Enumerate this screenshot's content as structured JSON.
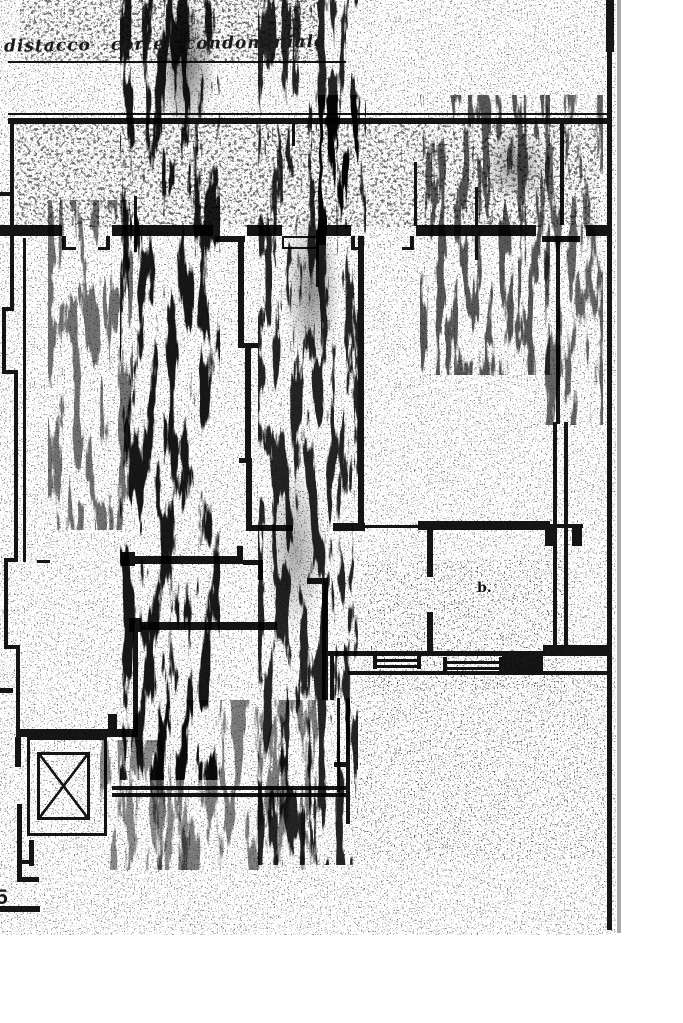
{
  "annotations": {
    "title": "distacco corte condominiale",
    "room_label": "b.",
    "margin_number": "5"
  },
  "symbols": [
    {
      "name": "elevator-shaft",
      "glyph": "boxed-x"
    }
  ],
  "colors": {
    "ink": "#161616",
    "paper": "#ffffff",
    "page_edge_gray": "#a9a9a9"
  }
}
